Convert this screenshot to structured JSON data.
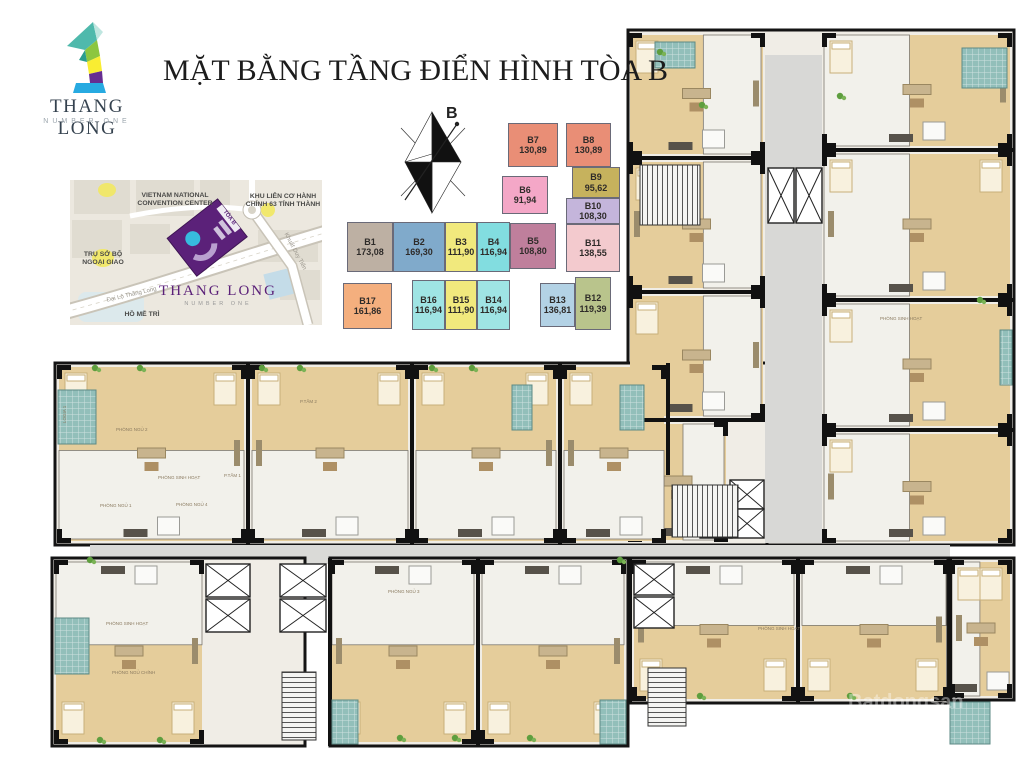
{
  "header": {
    "title": "MẶT BẰNG TẦNG ĐIỂN HÌNH TÒA B",
    "logo": {
      "numeral": "1",
      "name": "THANG LONG",
      "subtitle": "NUMBER ONE"
    }
  },
  "compass": {
    "label": "B"
  },
  "map": {
    "convention_line1": "VIETNAM NATIONAL",
    "convention_line2": "CONVENTION CENTER",
    "admin_line1": "KHU LIÊN CƠ HÀNH",
    "admin_line2": "CHÍNH 63 TỈNH THÀNH",
    "ministry_line1": "TRỤ SỞ BỘ",
    "ministry_line2": "NGOẠI GIAO",
    "road_main": "Đại Lộ Thăng Long",
    "road_side": "Khuất Duy Tiến",
    "project_name": "THANG LONG",
    "project_subtitle": "NUMBER ONE",
    "lake": "HỒ MỄ TRÌ",
    "building_tag": "TÒA B"
  },
  "legend": {
    "items": [
      {
        "code": "B1",
        "area": "173,08",
        "color": "#BDB0A3"
      },
      {
        "code": "B2",
        "area": "169,30",
        "color": "#80AACB"
      },
      {
        "code": "B3",
        "area": "111,90",
        "color": "#F1E97D"
      },
      {
        "code": "B4",
        "area": "116,94",
        "color": "#82DDE0"
      },
      {
        "code": "B5",
        "area": "108,80",
        "color": "#BF7F9C"
      },
      {
        "code": "B6",
        "area": "91,94",
        "color": "#F4A7C7"
      },
      {
        "code": "B7",
        "area": "130,89",
        "color": "#E98E76"
      },
      {
        "code": "B8",
        "area": "130,89",
        "color": "#E98E76"
      },
      {
        "code": "B9",
        "area": "95,62",
        "color": "#C6B25D"
      },
      {
        "code": "B10",
        "area": "108,30",
        "color": "#C4B5DB"
      },
      {
        "code": "B11",
        "area": "138,55",
        "color": "#F3CACE"
      },
      {
        "code": "B12",
        "area": "119,39",
        "color": "#B9C48C"
      },
      {
        "code": "B13",
        "area": "136,81",
        "color": "#B3D2E5"
      },
      {
        "code": "B14",
        "area": "116,94",
        "color": "#9FE4E4"
      },
      {
        "code": "B15",
        "area": "111,90",
        "color": "#F1E97D"
      },
      {
        "code": "B16",
        "area": "116,94",
        "color": "#9FE4E4"
      },
      {
        "code": "B17",
        "area": "161,86",
        "color": "#F4AF7E"
      }
    ]
  },
  "plan": {
    "room_labels": [
      "PHÒNG SINH HOẠT",
      "PHÒNG NGỦ 2",
      "PHÒNG NGỦ 1",
      "PHÒNG NGỦ 4",
      "P.TẮM 1",
      "LOGIA 1",
      "PHÒNG NGỦ CHÍNH",
      "PHÒNG NGỦ 3",
      "P.TẮM 2"
    ],
    "watermark": "Batdongsan"
  }
}
